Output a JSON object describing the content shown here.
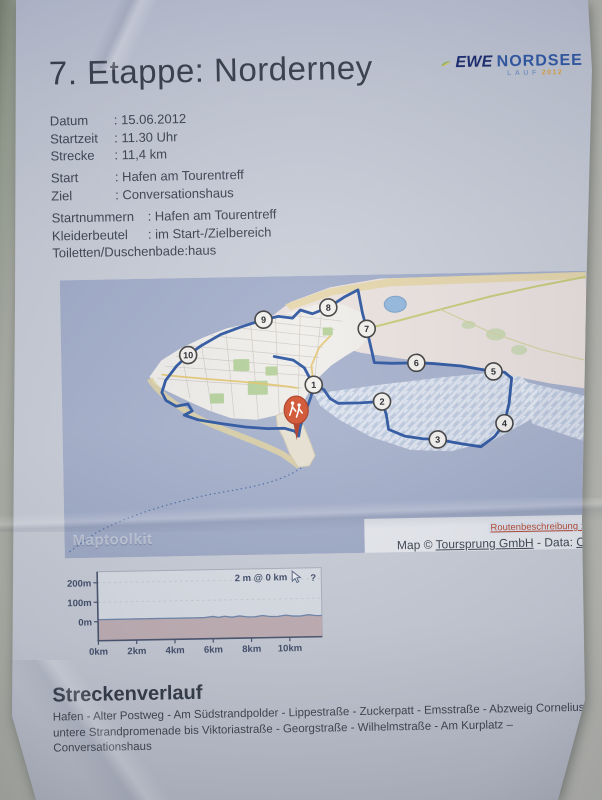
{
  "header": {
    "title": "7. Etappe: Norderney"
  },
  "logo": {
    "ewe": "EWE",
    "nordsee": "NORDSEE",
    "lauf": "LAUF",
    "year": "2012"
  },
  "details": {
    "schedule": [
      {
        "label": "Datum",
        "value": ": 15.06.2012"
      },
      {
        "label": "Startzeit",
        "value": ": 11.30 Uhr"
      },
      {
        "label": "Strecke",
        "value": ": 11,4 km"
      }
    ],
    "course": [
      {
        "label": "Start",
        "value": ": Hafen am Tourentreff"
      },
      {
        "label": "Ziel",
        "value": ": Conversationshaus"
      }
    ],
    "organisation": [
      {
        "label": "Startnummern",
        "value": ": Hafen am Tourentreff"
      },
      {
        "label": "Kleiderbeutel",
        "value": ": im Start-/Zielbereich"
      },
      {
        "label": "Toiletten/Duschen",
        "value": ": bade:haus"
      }
    ]
  },
  "map": {
    "watermark": "Maptoolkit",
    "route_link": "Routenbeschreibung :",
    "attribution_prefix": "Map © ",
    "attribution_link": "Toursprung GmbH",
    "attribution_mid": " - Data: ",
    "attribution_data_link": "O",
    "markers": [
      {
        "n": "1",
        "x": 252,
        "y": 109
      },
      {
        "n": "2",
        "x": 320,
        "y": 127
      },
      {
        "n": "3",
        "x": 375,
        "y": 166
      },
      {
        "n": "4",
        "x": 442,
        "y": 151
      },
      {
        "n": "5",
        "x": 432,
        "y": 99
      },
      {
        "n": "6",
        "x": 355,
        "y": 89
      },
      {
        "n": "7",
        "x": 306,
        "y": 54
      },
      {
        "n": "8",
        "x": 268,
        "y": 32
      },
      {
        "n": "9",
        "x": 203,
        "y": 43
      },
      {
        "n": "10",
        "x": 127,
        "y": 77
      }
    ],
    "route_color": "#2c55a0"
  },
  "chart_data": {
    "type": "area",
    "title": "",
    "xlabel": "distance (km)",
    "ylabel": "elevation (m)",
    "annotation": "2 m @ 0 km",
    "help_glyph": "?",
    "x_ticks": [
      "0km",
      "2km",
      "4km",
      "6km",
      "8km",
      "10km"
    ],
    "x_tick_km": [
      0,
      2,
      4,
      6,
      8,
      10
    ],
    "y_ticks": [
      "0m",
      "100m",
      "200m"
    ],
    "y_tick_m": [
      0,
      100,
      200
    ],
    "xlim_km": [
      0,
      11.7
    ],
    "ylim_m": [
      0,
      260
    ],
    "distance_km": [
      0,
      0.5,
      1,
      1.5,
      2,
      2.5,
      3,
      3.5,
      4,
      4.5,
      5,
      5.5,
      6,
      6.3,
      6.6,
      7,
      7.4,
      7.8,
      8.2,
      8.6,
      9,
      9.4,
      9.8,
      10.2,
      10.6,
      11,
      11.4
    ],
    "elevation_m": [
      2,
      2,
      2,
      2,
      2,
      2,
      2,
      2,
      2,
      2,
      2,
      2,
      3,
      2,
      3,
      2,
      3,
      2,
      2,
      3,
      2,
      2,
      3,
      2,
      2,
      3,
      2
    ]
  },
  "course_description": {
    "heading": "Streckenverlauf",
    "body": "Hafen - Alter Postweg - Am Südstrandpolder - Lippestraße - Zuckerpatt - Emsstraße - Abzweig Cornelius, untere Strandpromenade bis Viktoriastraße - Georgstraße - Wilhelmstraße - Am Kurplatz – Conversationshaus"
  }
}
